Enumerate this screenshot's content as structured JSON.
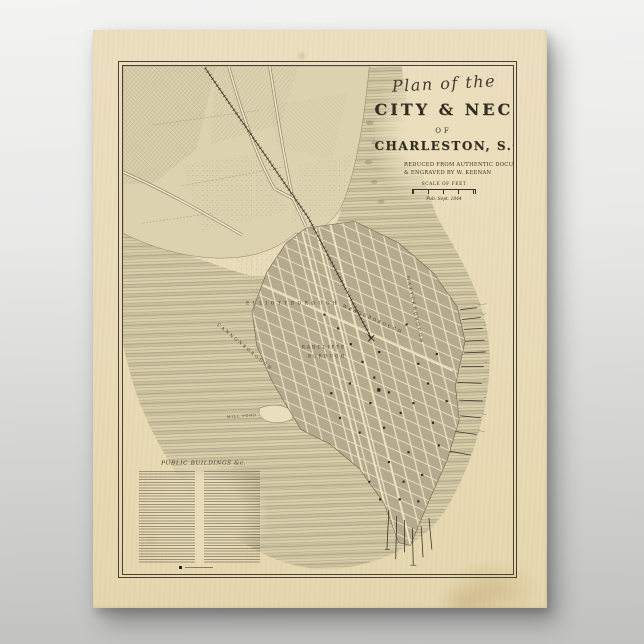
{
  "scene": {
    "background_color": "#d8d8d7",
    "description": "Vintage map poster on gray studio background"
  },
  "poster": {
    "paper_color": "#e9dcb9",
    "ink_color": "#3a3427",
    "title": {
      "script": "Plan of the",
      "line1": "CITY & NECK",
      "of": "OF",
      "line2": "CHARLESTON, S.C.",
      "credit1": "REDUCED FROM AUTHENTIC DOCUMENTS",
      "credit2": "& ENGRAVED BY W. KEENAN",
      "scale_label": "SCALE OF FEET",
      "pub_line": "Pub. Sept. 1844"
    },
    "legend": {
      "heading": "PUBLIC BUILDINGS &c."
    },
    "map_labels": {
      "elliottborough": "ELLIOTTBOROUGH",
      "radcliffeborough_line1": "RADCLIFFE",
      "radcliffeborough_line2": "BOROUGH",
      "cannonborough": "CANNONBOROUGH",
      "wraggborough": "WRAGGBOROUGH",
      "mazyckborough": "MAZYCKBOROUGH",
      "mill_pond": "MILL POND"
    },
    "colors": {
      "water_stripe": "#8e8568",
      "land": "#ddd2b0",
      "city_block": "#b4aa8d",
      "street": "#eae0bf"
    }
  }
}
